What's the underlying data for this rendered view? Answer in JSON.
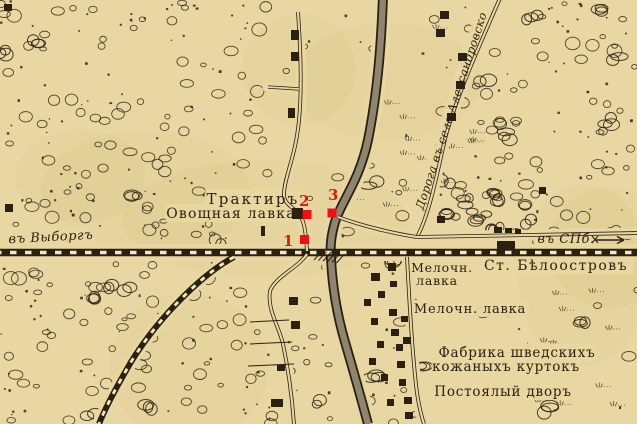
{
  "colors": {
    "paper": "#e8d7a2",
    "paper_light": "#f3e8c4",
    "ink": "#2a2110",
    "band_fill": "#8d8570",
    "marker_red": "#ee1111",
    "digit_red": "#d81a12"
  },
  "labels": [
    {
      "name": "label-traktir",
      "text": "Трактиръ",
      "x": 253,
      "y": 204,
      "size": 15,
      "style": "serif",
      "spacing": 2.2
    },
    {
      "name": "label-ovoshchnaya-lavka",
      "text": "Овощная лавка",
      "x": 231,
      "y": 218,
      "size": 14,
      "style": "serif",
      "spacing": 1.2
    },
    {
      "name": "label-to-vyborg",
      "text": "въ Выборгъ",
      "x": 51,
      "y": 241,
      "size": 13,
      "style": "italic",
      "spacing": 0.5,
      "rotate": -3
    },
    {
      "name": "label-to-spb",
      "text": "въ СПб.",
      "x": 566,
      "y": 243,
      "size": 13,
      "style": "italic",
      "spacing": 0.5
    },
    {
      "name": "label-station-beloostrov",
      "text": "Ст. Бѣлоостровъ",
      "x": 556,
      "y": 270,
      "size": 14,
      "style": "serif",
      "spacing": 1.5
    },
    {
      "name": "label-melochn-lavka-1-line1",
      "text": "Мелочн.",
      "x": 442,
      "y": 272,
      "size": 12.5,
      "style": "serif",
      "spacing": 0.8
    },
    {
      "name": "label-melochn-lavka-1-line2",
      "text": "лавка",
      "x": 437,
      "y": 285,
      "size": 12.5,
      "style": "serif",
      "spacing": 0.8
    },
    {
      "name": "label-melochn-lavka-2",
      "text": "Мелочн. лавка",
      "x": 470,
      "y": 313,
      "size": 13,
      "style": "serif",
      "spacing": 0.8
    },
    {
      "name": "label-fabrika-line1",
      "text": "Фабрика шведскихъ",
      "x": 517,
      "y": 357,
      "size": 13.5,
      "style": "serif",
      "spacing": 0.8
    },
    {
      "name": "label-fabrika-line2",
      "text": "кожаныхъ куртокъ",
      "x": 506,
      "y": 371,
      "size": 13.5,
      "style": "serif",
      "spacing": 0.8
    },
    {
      "name": "label-postoyaly-dvor",
      "text": "Постоялый дворъ",
      "x": 503,
      "y": 396,
      "size": 13.5,
      "style": "serif",
      "spacing": 0.8
    },
    {
      "name": "label-road-to-alexandrovskoe",
      "text": "Дорога въ село Александровско",
      "x": 455,
      "y": 112,
      "size": 11.5,
      "style": "italic",
      "spacing": 0.4,
      "rotate": -72
    }
  ],
  "markers": [
    {
      "n": "1",
      "digit_x": 283,
      "digit_y": 246,
      "sq_x": 300,
      "sq_y": 235
    },
    {
      "n": "2",
      "digit_x": 299,
      "digit_y": 206,
      "sq_x": 302.5,
      "sq_y": 210
    },
    {
      "n": "3",
      "digit_x": 328,
      "digit_y": 200,
      "sq_x": 327.5,
      "sq_y": 208.5
    }
  ],
  "features": {
    "railway_main": "M-5,252.5 L642,252.5",
    "railway_branch": "M234,257 C206,272 162,312 131,362 C117,386 106,406 99,424",
    "highway_band": "M383,-4 C381,50 377,95 368,140 C359,182 342,200 335,222 C331,236 330,246 331,258 C332,280 335,308 345,342 C354,373 361,398 368,424",
    "roads": [
      {
        "name": "road-left-north",
        "d": "M298,12 C301,55 302,90 299,120 C296,155 285,175 284,193 C283,205 295,207 301,217 C305,224 306,236 307,251"
      },
      {
        "name": "road-west-stub",
        "d": "M268,87 L299,89",
        "thin": true
      },
      {
        "name": "road-left-south",
        "d": "M307,254 C298,268 276,276 270,291 C267,310 279,326 283,344 C288,368 292,396 294,424"
      },
      {
        "name": "road-alexandrovskoe",
        "d": "M501,-4 C484,35 459,90 446,135 C439,163 431,211 417,237"
      },
      {
        "name": "road-station-east",
        "d": "M417,237 L640,233"
      },
      {
        "name": "road-crossing-east",
        "d": "M338,217 C362,226 396,234 417,237"
      },
      {
        "name": "road-village-south",
        "d": "M407,257 C409,295 411,335 415,375 C417,398 420,412 424,424"
      }
    ],
    "field_lines": [
      "M250,322 L289,320",
      "M250,344 L292,342",
      "M248,366 L294,364"
    ],
    "buildings": [
      [
        4,
        4,
        8,
        7
      ],
      [
        5,
        204,
        8,
        8
      ],
      [
        291,
        30,
        8,
        10
      ],
      [
        291,
        52,
        8,
        9
      ],
      [
        288,
        108,
        7,
        10
      ],
      [
        292,
        208,
        11,
        11
      ],
      [
        261,
        226,
        4,
        10
      ],
      [
        440,
        11,
        9,
        8
      ],
      [
        436,
        29,
        9,
        8
      ],
      [
        458,
        53,
        9,
        8
      ],
      [
        456,
        81,
        9,
        8
      ],
      [
        447,
        113,
        9,
        8
      ],
      [
        539,
        187,
        7,
        7
      ],
      [
        437,
        216,
        8,
        7
      ],
      [
        494,
        227,
        8,
        6
      ],
      [
        505,
        228,
        7,
        5
      ],
      [
        515,
        229,
        6,
        5
      ],
      [
        497,
        241,
        18,
        8
      ],
      [
        388,
        263,
        8,
        8
      ],
      [
        371,
        273,
        9,
        8
      ],
      [
        390,
        281,
        7,
        6
      ],
      [
        378,
        291,
        7,
        7
      ],
      [
        364,
        299,
        7,
        7
      ],
      [
        389,
        309,
        8,
        7
      ],
      [
        371,
        318,
        7,
        7
      ],
      [
        391,
        329,
        8,
        7
      ],
      [
        377,
        341,
        7,
        7
      ],
      [
        396,
        344,
        7,
        7
      ],
      [
        369,
        358,
        7,
        7
      ],
      [
        397,
        361,
        8,
        7
      ],
      [
        381,
        374,
        7,
        7
      ],
      [
        399,
        379,
        7,
        7
      ],
      [
        403,
        337,
        8,
        7
      ],
      [
        401,
        316,
        7,
        6
      ],
      [
        404,
        397,
        8,
        7
      ],
      [
        387,
        399,
        7,
        7
      ],
      [
        405,
        412,
        8,
        7
      ],
      [
        289,
        297,
        9,
        8
      ],
      [
        291,
        321,
        9,
        8
      ],
      [
        277,
        365,
        8,
        6
      ],
      [
        271,
        399,
        12,
        8
      ]
    ],
    "spb_arrow": {
      "line": "M596,240 L624,240",
      "head": "M624,240 l-7,-3.5 M624,240 l-7,3.5",
      "tick": "M592,236 l6,7 M598,236 l-6,7"
    }
  }
}
